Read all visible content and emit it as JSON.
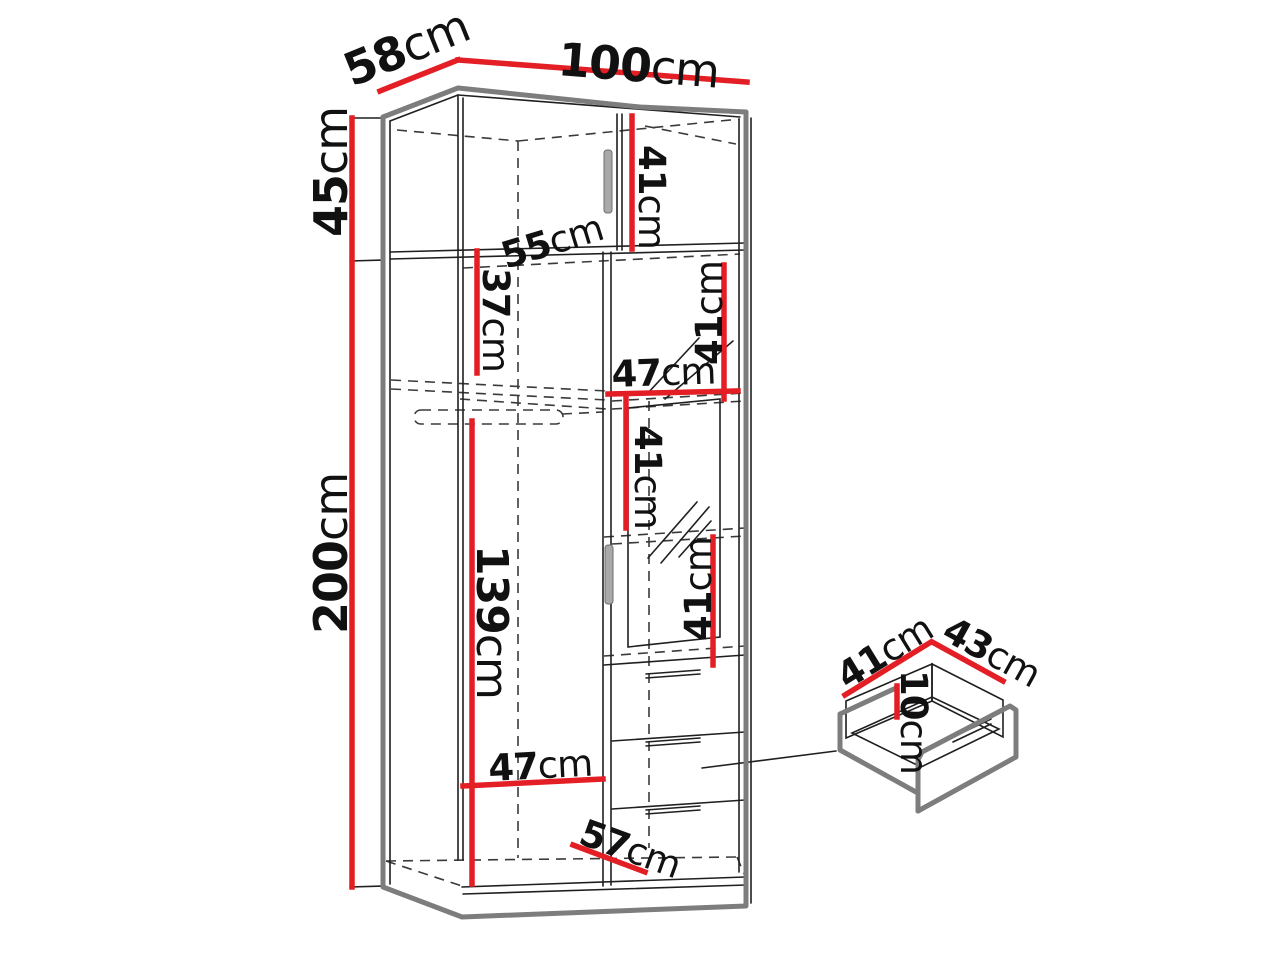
{
  "title": "Wardrobe technical dimensions diagram",
  "colors": {
    "dim_red": "#e31e24",
    "outline_gray": "#7d7d7d",
    "line_black": "#1f1f1f",
    "bg": "#ffffff"
  },
  "unit": "cm",
  "dimensions": {
    "top_width": {
      "num": "100",
      "unit": "cm"
    },
    "top_depth": {
      "num": "58",
      "unit": "cm"
    },
    "top_section_height": {
      "num": "45",
      "unit": "cm"
    },
    "total_height": {
      "num": "200",
      "unit": "cm"
    },
    "top_inner_height": {
      "num": "41",
      "unit": "cm"
    },
    "shelf_depth": {
      "num": "55",
      "unit": "cm"
    },
    "shelf_gap": {
      "num": "37",
      "unit": "cm"
    },
    "right_top_gap": {
      "num": "41",
      "unit": "cm"
    },
    "right_inner_width": {
      "num": "47",
      "unit": "cm"
    },
    "right_mid_gap": {
      "num": "41",
      "unit": "cm"
    },
    "right_lower_gap": {
      "num": "41",
      "unit": "cm"
    },
    "hanging_space": {
      "num": "139",
      "unit": "cm"
    },
    "left_inner_width": {
      "num": "47",
      "unit": "cm"
    },
    "bottom_depth": {
      "num": "57",
      "unit": "cm"
    },
    "drawer_depth": {
      "num": "41",
      "unit": "cm"
    },
    "drawer_width": {
      "num": "43",
      "unit": "cm"
    },
    "drawer_height": {
      "num": "10",
      "unit": "cm"
    }
  }
}
